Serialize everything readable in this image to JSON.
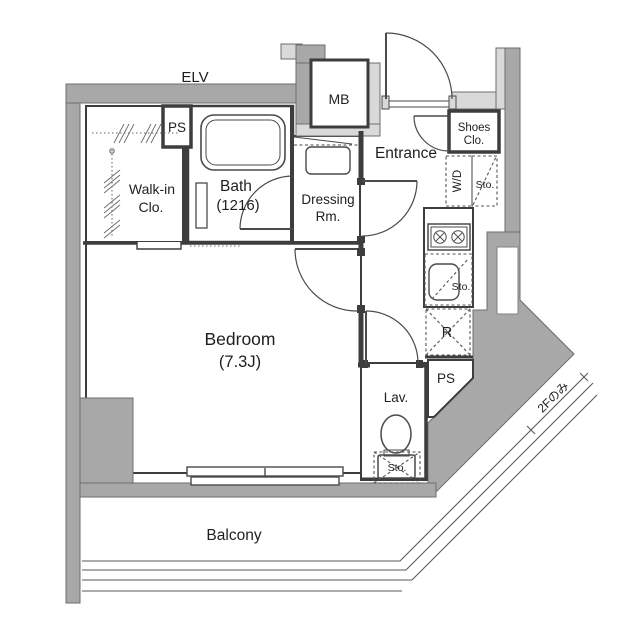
{
  "colors": {
    "wall_dark": "#a8a8a8",
    "wall_light": "#d9d9d9",
    "line": "#3d3d3d",
    "fixture_line": "#4a4a4a",
    "text": "#1f1f1f"
  },
  "labels": {
    "elevator": "ELV",
    "ps_top": "PS",
    "walkin_line1": "Walk-in",
    "walkin_line2": "Clo.",
    "bath_line1": "Bath",
    "bath_line2": "(1216)",
    "dressing_line1": "Dressing",
    "dressing_line2": "Rm.",
    "meter_box": "MB",
    "entrance": "Entrance",
    "shoes_line1": "Shoes",
    "shoes_line2": "Clo.",
    "washer_dryer": "W/D",
    "storage_hall": "Sto.",
    "storage_kitchen": "Sto.",
    "refrigerator": "R",
    "ps_bottom": "PS",
    "lavatory": "Lav.",
    "storage_lavatory": "Sto.",
    "bedroom_line1": "Bedroom",
    "bedroom_line2": "(7.3J)",
    "balcony": "Balcony",
    "floor_note": "2Fのみ"
  }
}
